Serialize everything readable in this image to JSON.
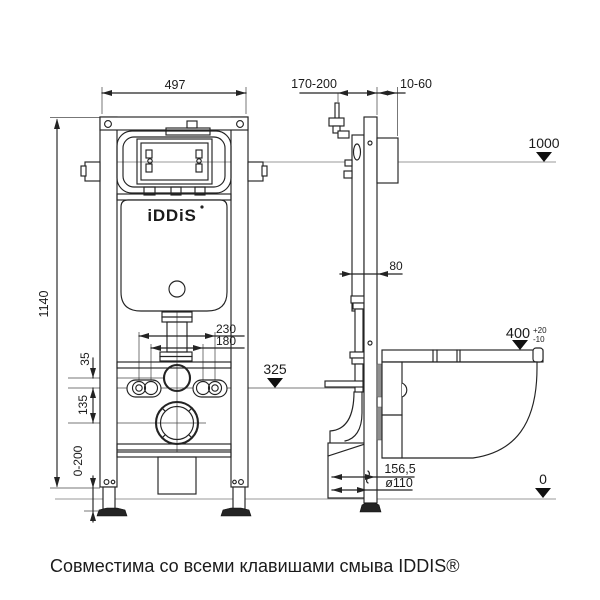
{
  "caption": "Совместима со всеми клавишами смыва IDDIS®",
  "brand_logo": "iDDiS",
  "front_view": {
    "width": "497",
    "height": "1140",
    "bolt_spacing_outer": "230",
    "bolt_spacing_inner": "180",
    "pipe_offset": "35",
    "drain_offset": "135",
    "outlet_level": "325",
    "feet_adjust_range": "0-200"
  },
  "side_view": {
    "install_depth_range": "170-200",
    "wall_finish_range": "10-60",
    "top_level": "1000",
    "profile_depth": "80",
    "bowl_height": "400",
    "bowl_height_tol_plus": "+20",
    "bowl_height_tol_minus": "-10",
    "drain_to_wall": "156,5",
    "drain_diameter": "ø110",
    "floor_level": "0"
  }
}
